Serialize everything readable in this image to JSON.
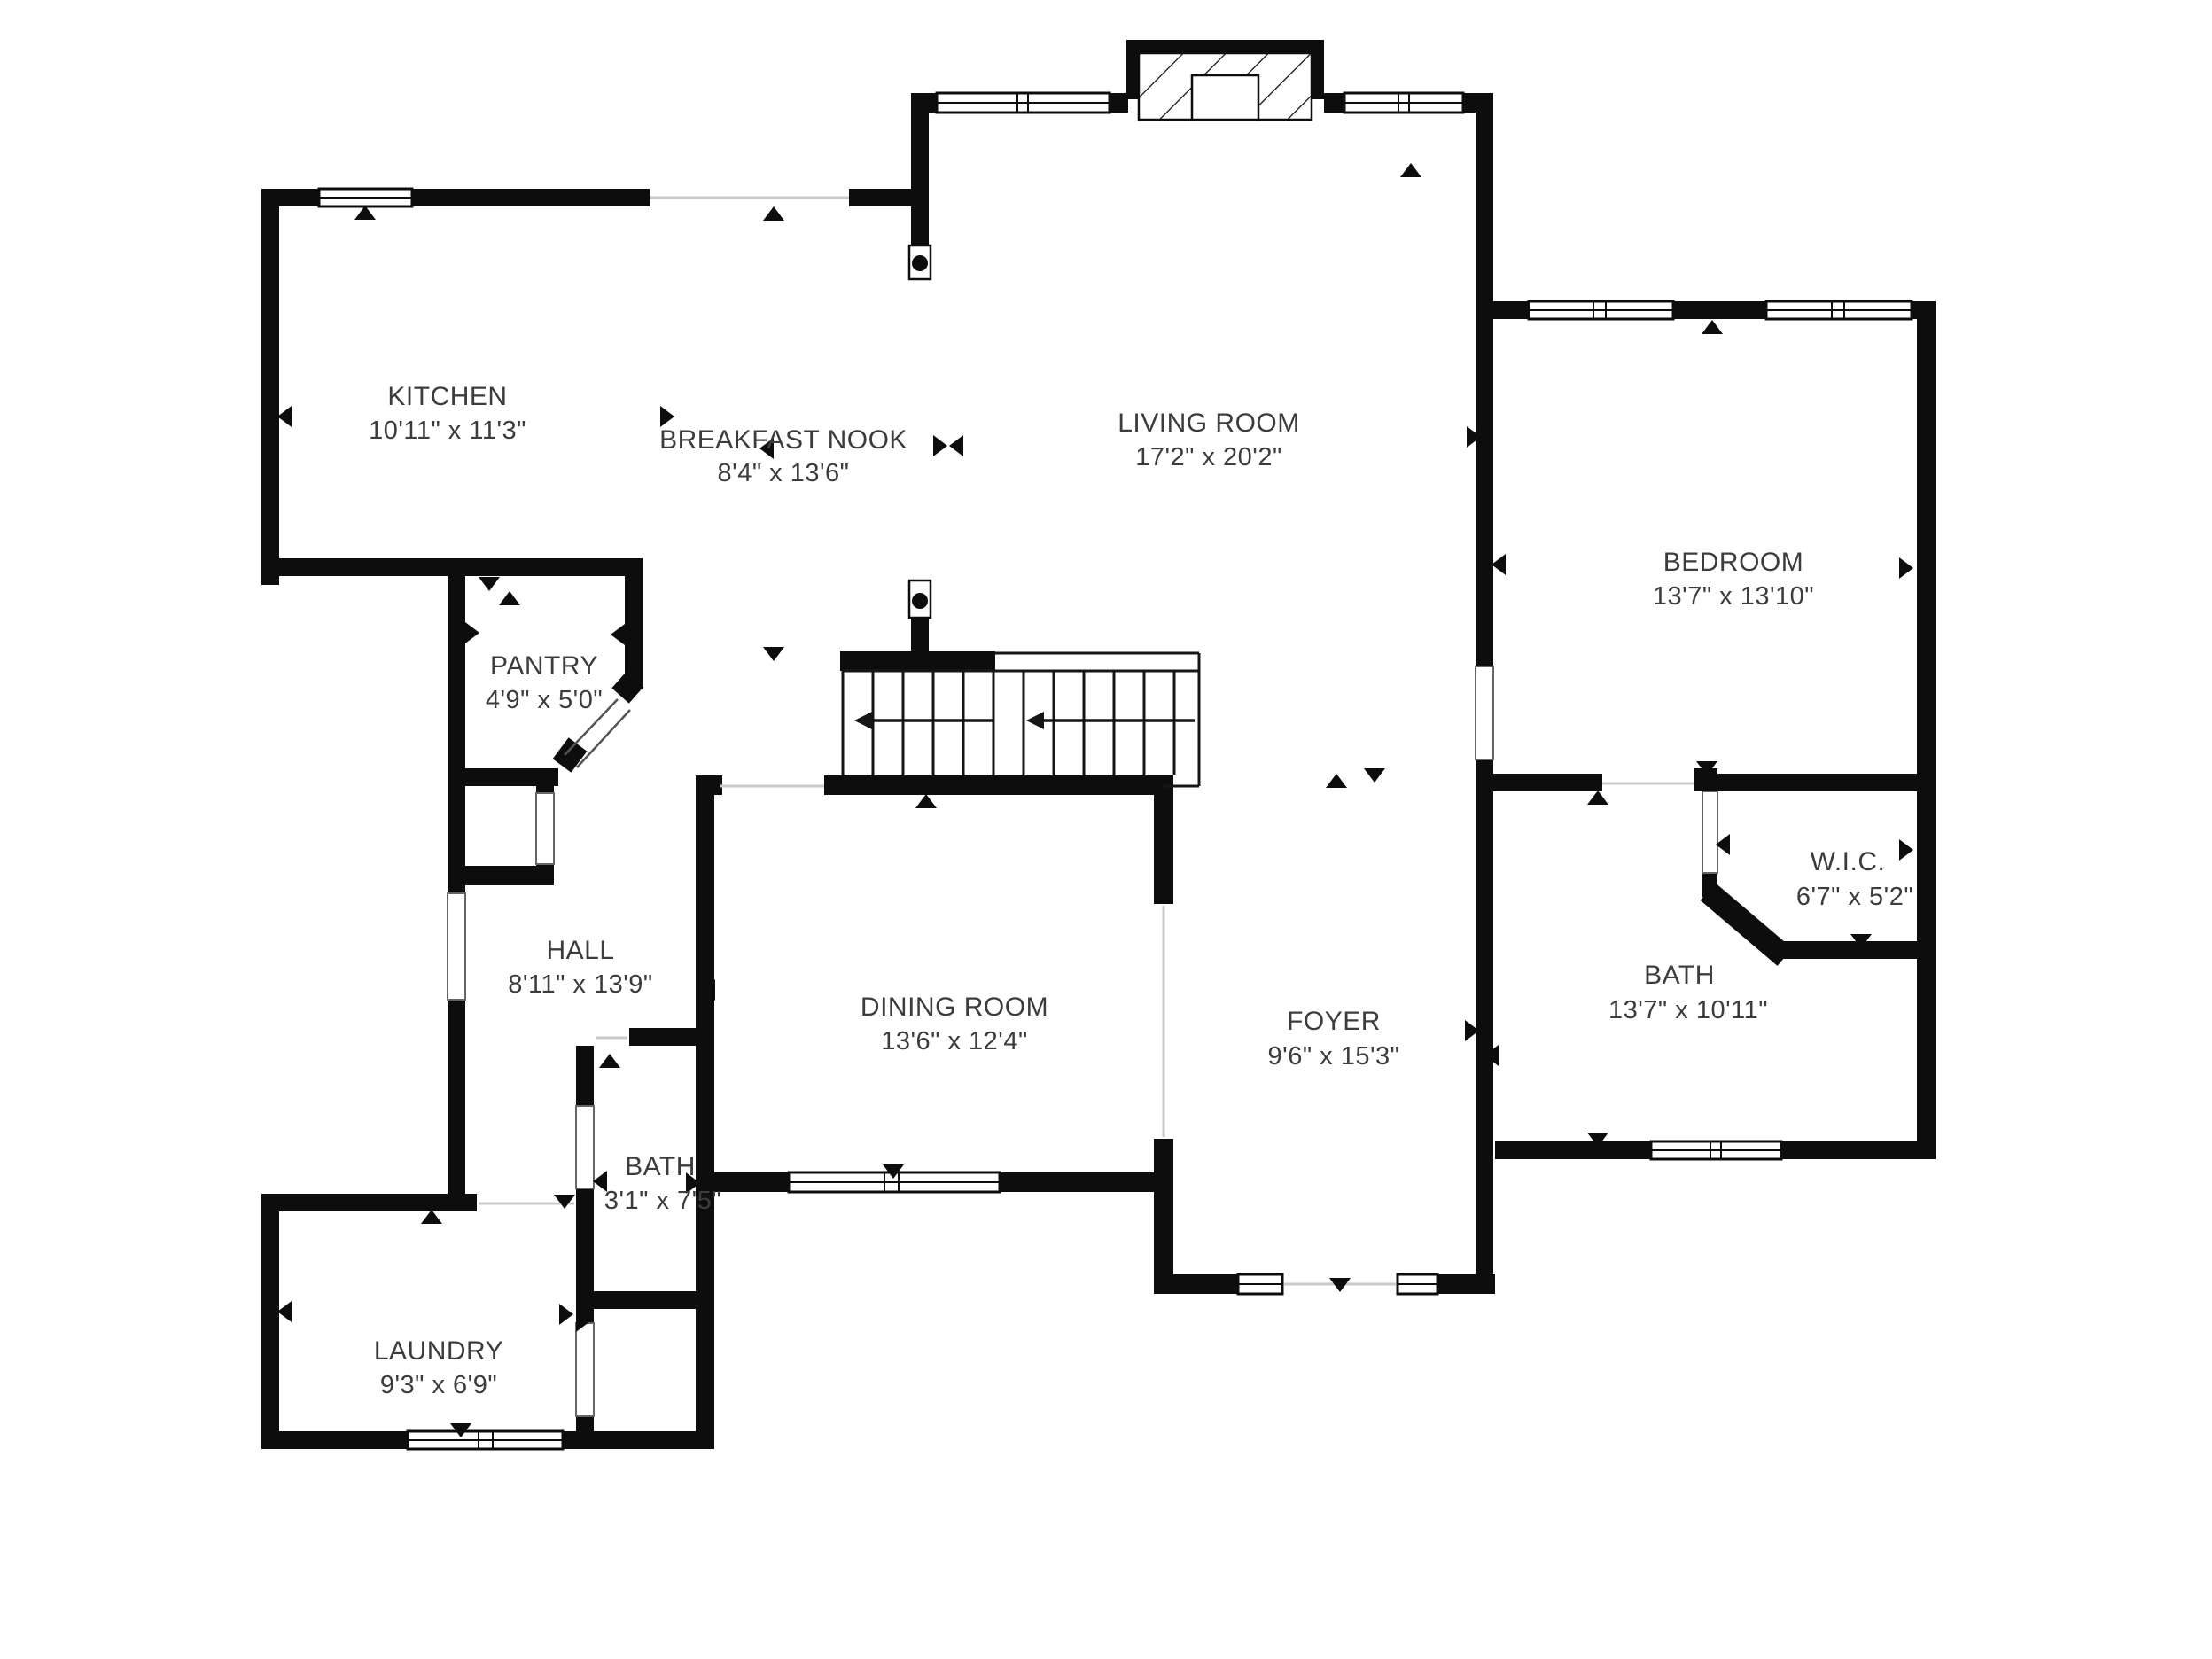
{
  "colors": {
    "wall": "#0d0d0d",
    "label_text": "#3c3c3c",
    "background": "#ffffff"
  },
  "rooms": [
    {
      "id": "kitchen",
      "name": "KITCHEN",
      "dims": "10'11\" x 11'3\""
    },
    {
      "id": "breakfast_nook",
      "name": "BREAKFAST NOOK",
      "dims": "8'4\" x 13'6\""
    },
    {
      "id": "living_room",
      "name": "LIVING ROOM",
      "dims": "17'2\" x 20'2\""
    },
    {
      "id": "bedroom",
      "name": "BEDROOM",
      "dims": "13'7\" x 13'10\""
    },
    {
      "id": "pantry",
      "name": "PANTRY",
      "dims": "4'9\" x 5'0\""
    },
    {
      "id": "hall",
      "name": "HALL",
      "dims": "8'11\" x 13'9\""
    },
    {
      "id": "dining_room",
      "name": "DINING ROOM",
      "dims": "13'6\" x 12'4\""
    },
    {
      "id": "foyer",
      "name": "FOYER",
      "dims": "9'6\" x 15'3\""
    },
    {
      "id": "wic",
      "name": "W.I.C.",
      "dims": "6'7\" x 5'2\""
    },
    {
      "id": "bath_primary",
      "name": "BATH",
      "dims": "13'7\" x 10'11\""
    },
    {
      "id": "bath_hall",
      "name": "BATH",
      "dims": "3'1\" x 7'5\""
    },
    {
      "id": "laundry",
      "name": "LAUNDRY",
      "dims": "9'3\" x 6'9\""
    }
  ]
}
